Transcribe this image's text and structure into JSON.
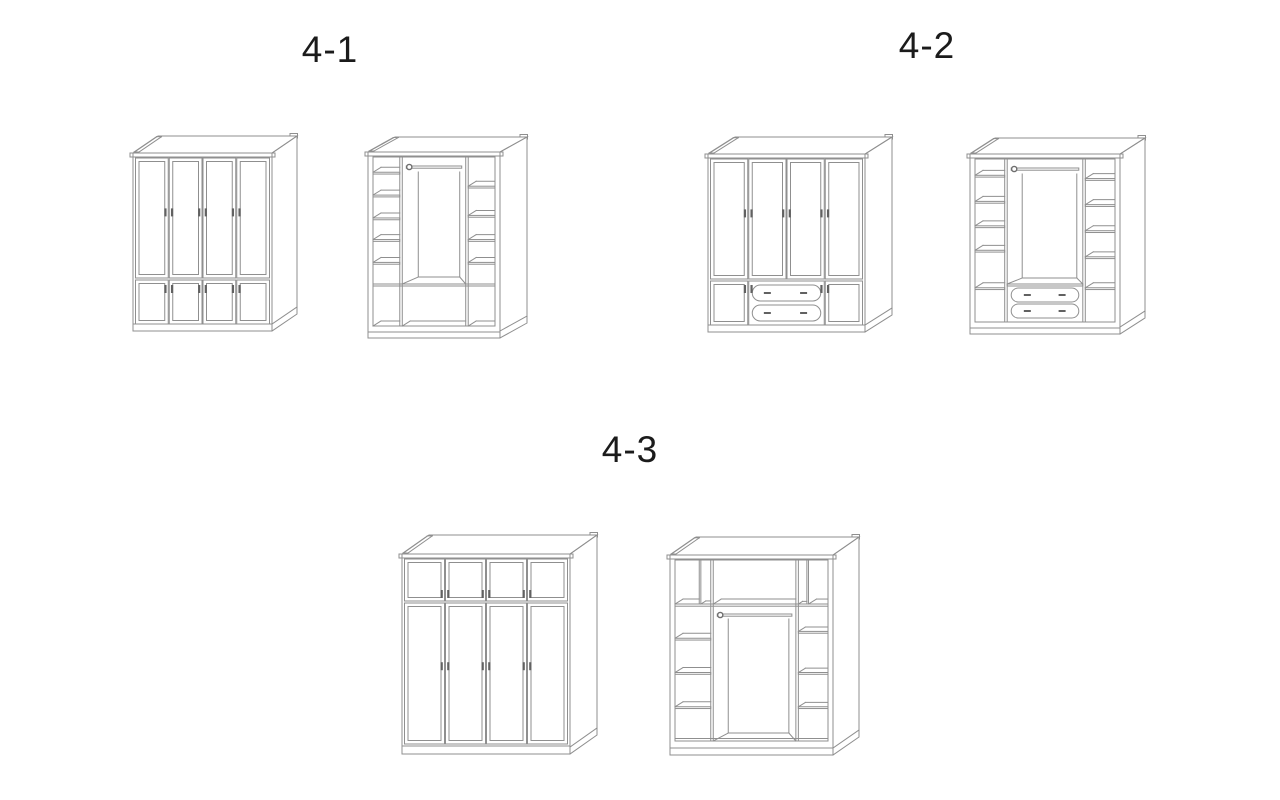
{
  "page": {
    "background": "#ffffff",
    "line_color": "#8f8f8f",
    "handle_color": "#616161",
    "text_color": "#1b1b1b"
  },
  "groups": [
    {
      "label": "4-1",
      "drawings": [
        {
          "name": "wardrobe-4-1-closed",
          "kind": "closed-lower-doors",
          "view": "closed front view",
          "description": "Four-door wardrobe with four small lower doors"
        },
        {
          "name": "wardrobe-4-1-open",
          "kind": "open-bottom-row",
          "view": "open interior view",
          "description": "Interior with left and right shelf columns, hanging rod and full-width bottom compartment row"
        }
      ]
    },
    {
      "label": "4-2",
      "drawings": [
        {
          "name": "wardrobe-4-2-closed",
          "kind": "closed-lower-drawers",
          "view": "closed front view",
          "description": "Four-door wardrobe with two centre drawers flanked by small lower doors"
        },
        {
          "name": "wardrobe-4-2-open",
          "kind": "open-middle-drawers",
          "view": "open interior view",
          "description": "Interior with side shelf columns, hanging rod and two centre drawers"
        }
      ]
    },
    {
      "label": "4-3",
      "drawings": [
        {
          "name": "wardrobe-4-3-closed",
          "kind": "closed-upper-doors",
          "view": "closed front view",
          "description": "Wardrobe with four small upper doors above four tall doors"
        },
        {
          "name": "wardrobe-4-3-open",
          "kind": "open-upper-row",
          "view": "open interior view",
          "description": "Interior with top compartment row, hanging rod and side shelf columns"
        }
      ]
    }
  ]
}
